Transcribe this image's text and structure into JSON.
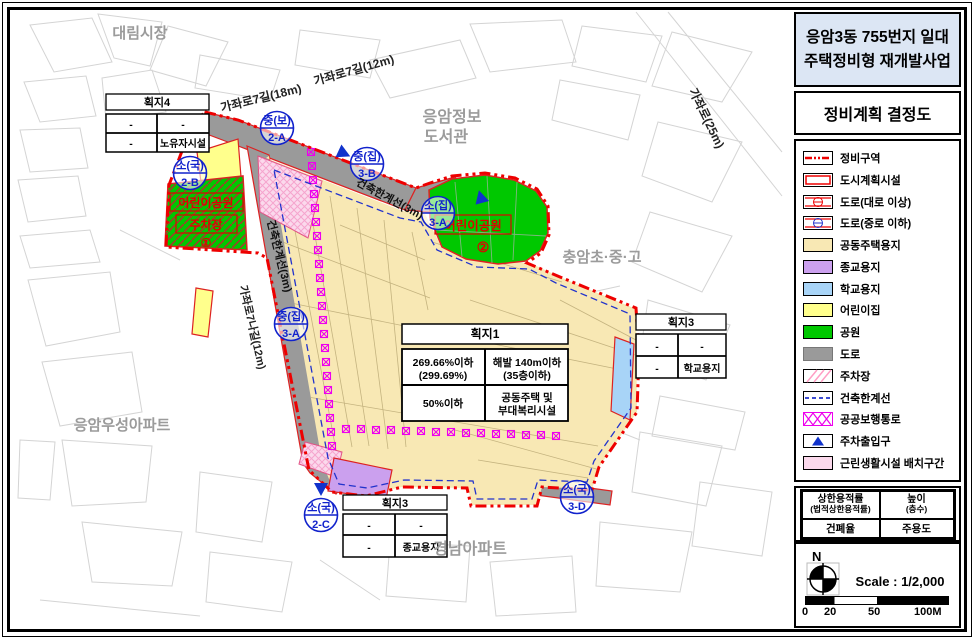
{
  "project": {
    "title_line1": "응암3동 755번지 일대",
    "title_line2": "주택정비형 재개발사업"
  },
  "doc_title": "정비계획 결정도",
  "legend": {
    "items": [
      {
        "label": "정비구역"
      },
      {
        "label": "도시계획시설"
      },
      {
        "label": "도로(대로 이상)"
      },
      {
        "label": "도로(중로 이하)"
      },
      {
        "label": "공동주택용지"
      },
      {
        "label": "종교용지"
      },
      {
        "label": "학교용지"
      },
      {
        "label": "어린이집"
      },
      {
        "label": "공원"
      },
      {
        "label": "도로"
      },
      {
        "label": "주차장"
      },
      {
        "label": "건축한계선"
      },
      {
        "label": "공공보행통로"
      },
      {
        "label": "주차출입구"
      },
      {
        "label": "근린생활시설 배치구간"
      }
    ]
  },
  "criteria_table": {
    "r1c1_line1": "상한용적률",
    "r1c1_line2": "(법적상한용적률)",
    "r1c2_line1": "높이",
    "r1c2_line2": "(층수)",
    "r2c1": "건폐율",
    "r2c2": "주용도"
  },
  "scale_box": {
    "north": "N",
    "scale_label": "Scale : 1/2,000",
    "tick0": "0",
    "tick20": "20",
    "tick50": "50",
    "tick100": "100M"
  },
  "map": {
    "area_labels": {
      "daelim_market": "대림시장",
      "library_line1": "응암정보",
      "library_line2": "도서관",
      "chungam_school": "충암초·중·고",
      "wooseong_apt": "응암우성아파트",
      "gyeongnam_apt": "경남아파트"
    },
    "road_labels": {
      "gajwaro7_18": "가좌로7길(18m)",
      "gajwaro7_12": "가좌로7길(12m)",
      "gajwaro_25": "가좌로(25m)",
      "gajwaro7na_12": "가좌로7나길(12m)",
      "building_limit_1": "건축한계선(3m)",
      "building_limit_2": "건축한계선(3m)"
    },
    "parks": {
      "park1_name": "어린이공원",
      "park1_sub": "주차장",
      "park1_no": "①",
      "park2_name": "어린이공원",
      "park2_no": "②"
    },
    "road_symbols": [
      {
        "top": "중(보)",
        "bottom": "2-A"
      },
      {
        "top": "소(국)",
        "bottom": "2-B"
      },
      {
        "top": "중(집)",
        "bottom": "3-B"
      },
      {
        "top": "소(집)",
        "bottom": "3-A"
      },
      {
        "top": "중(집)",
        "bottom": "3-A"
      },
      {
        "top": "소(국)",
        "bottom": "2-C"
      },
      {
        "top": "소(국)",
        "bottom": "3-D"
      }
    ],
    "parcel1": {
      "title": "획지1",
      "r1c1_line1": "269.66%이하",
      "r1c1_line2": "(299.69%)",
      "r1c2_line1": "해발 140m이하",
      "r1c2_line2": "(35층이하)",
      "r2c1": "50%이하",
      "r2c2_line1": "공동주택 및",
      "r2c2_line2": "부대복리시설"
    },
    "parcel4": {
      "title": "획지4",
      "r1c1": "-",
      "r1c2": "-",
      "r2c1": "-",
      "r2c2": "노유자시설"
    },
    "parcel3_school": {
      "title": "획지3",
      "r1c1": "-",
      "r1c2": "-",
      "r2c1": "-",
      "r2c2": "학교용지"
    },
    "parcel3_religion": {
      "title": "획지3",
      "r1c1": "-",
      "r1c2": "-",
      "r2c1": "-",
      "r2c2": "종교용지"
    }
  },
  "colors": {
    "residential": "#F8E8B4",
    "religious": "#CBA0EE",
    "school": "#A8D4F7",
    "daycare": "#FFFF8C",
    "park": "#00C800",
    "road": "#9A9A9A",
    "neighborhood_facility": "#FBD9EC",
    "boundary_red": "#EE0000",
    "limit_line_blue": "#2233CC",
    "pedestrian_magenta": "#EE00EE",
    "title_bg": "#DCE6F4"
  }
}
